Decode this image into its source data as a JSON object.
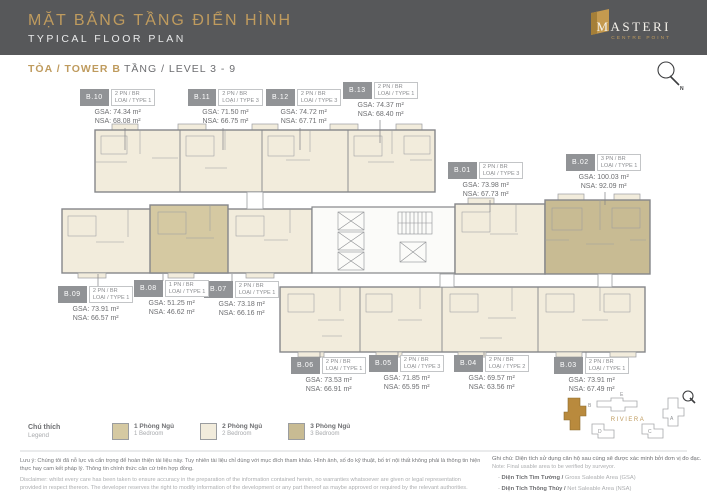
{
  "header": {
    "title_vi": "MẶT BẰNG TẦNG ĐIỂN HÌNH",
    "title_en": "TYPICAL FLOOR PLAN",
    "logo": {
      "name": "MASTERI",
      "subname": "CENTRE POINT"
    }
  },
  "subheader": {
    "tower_label": "TÒA / TOWER B",
    "level_label": "TẦNG / LEVEL 3 - 9"
  },
  "compass": {
    "label": "N"
  },
  "units": [
    {
      "id": "B.01",
      "bedrooms": "2 PN / BR",
      "type": "LOẠI / TYPE 3",
      "gsa": "GSA: 73.98 m²",
      "nsa": "NSA: 67.73 m²"
    },
    {
      "id": "B.02",
      "bedrooms": "3 PN / BR",
      "type": "LOẠI / TYPE 1",
      "gsa": "GSA: 100.03 m²",
      "nsa": "NSA: 92.09 m²"
    },
    {
      "id": "B.03",
      "bedrooms": "2 PN / BR",
      "type": "LOẠI / TYPE 1",
      "gsa": "GSA: 73.91 m²",
      "nsa": "NSA: 67.49 m²"
    },
    {
      "id": "B.04",
      "bedrooms": "2 PN / BR",
      "type": "LOẠI / TYPE 2",
      "gsa": "GSA: 69.57 m²",
      "nsa": "NSA: 63.56 m²"
    },
    {
      "id": "B.05",
      "bedrooms": "2 PN / BR",
      "type": "LOẠI / TYPE 3",
      "gsa": "GSA: 71.85 m²",
      "nsa": "NSA: 65.95 m²"
    },
    {
      "id": "B.06",
      "bedrooms": "2 PN / BR",
      "type": "LOẠI / TYPE 1",
      "gsa": "GSA: 73.53 m²",
      "nsa": "NSA: 66.91 m²"
    },
    {
      "id": "B.07",
      "bedrooms": "2 PN / BR",
      "type": "LOẠI / TYPE 1",
      "gsa": "GSA: 73.18 m²",
      "nsa": "NSA: 66.16 m²"
    },
    {
      "id": "B.08",
      "bedrooms": "1 PN / BR",
      "type": "LOẠI / TYPE 1",
      "gsa": "GSA: 51.25 m²",
      "nsa": "NSA: 46.62 m²"
    },
    {
      "id": "B.09",
      "bedrooms": "2 PN / BR",
      "type": "LOẠI / TYPE 1",
      "gsa": "GSA: 73.91 m²",
      "nsa": "NSA: 66.57 m²"
    },
    {
      "id": "B.10",
      "bedrooms": "2 PN / BR",
      "type": "LOẠI / TYPE 1",
      "gsa": "GSA: 74.34 m²",
      "nsa": "NSA: 68.08 m²"
    },
    {
      "id": "B.11",
      "bedrooms": "2 PN / BR",
      "type": "LOẠI / TYPE 3",
      "gsa": "GSA: 71.50 m²",
      "nsa": "NSA: 66.75 m²"
    },
    {
      "id": "B.12",
      "bedrooms": "2 PN / BR",
      "type": "LOẠI / TYPE 3",
      "gsa": "GSA: 74.72 m²",
      "nsa": "NSA: 67.71 m²"
    },
    {
      "id": "B.13",
      "bedrooms": "2 PN / BR",
      "type": "LOẠI / TYPE 1",
      "gsa": "GSA: 74.37 m²",
      "nsa": "NSA: 68.40 m²"
    }
  ],
  "legend": {
    "label_vi": "Chú thích",
    "label_en": "Legend",
    "items": [
      {
        "label_vi": "1 Phòng Ngủ",
        "label_en": "1 Bedroom",
        "color": "#d5c9a2"
      },
      {
        "label_vi": "2 Phòng Ngủ",
        "label_en": "2 Bedroom",
        "color": "#f2ecdc"
      },
      {
        "label_vi": "3 Phòng Ngủ",
        "label_en": "3 Bedroom",
        "color": "#c8bb93"
      }
    ]
  },
  "keyplan": {
    "district_label": "RIVIERA",
    "buildings": [
      "E",
      "B",
      "A",
      "D",
      "C"
    ],
    "highlighted": "B"
  },
  "footer": {
    "disclaimer_vi": "Lưu ý: Chúng tôi đã nỗ lực và cẩn trọng để hoàn thiện tài liệu này. Tuy nhiên tài liệu chỉ dùng với mục đích tham khảo. Hình ảnh, số đo kỹ thuật, bố trí nội thất không phải là thông tin hiện thực hay cam kết pháp lý. Thông tin chính thức căn cứ trên hợp đồng.",
    "disclaimer_en": "Disclaimer: whilst every care has been taken to ensure accuracy in the preparation of the information contained herein, no warranties whatsoever are given or legal representation provided in respect thereon. The developer reserves the right to modify information of the development or any part thereof as maybe approved or required by the relevant authorities.",
    "note_title_vi": "Ghi chú: Diện tích sử dụng căn hộ sau cùng sẽ được xác minh bởi đơn vị đo đạc.",
    "note_title_en": "Note: Final usable area to be verified by surveyor.",
    "note_items": [
      {
        "vi": "Diện Tích Tim Tường /",
        "en": "Gross Saleable Area (GSA)"
      },
      {
        "vi": "Diện Tích Thông Thủy /",
        "en": "Net Saleable Area (NSA)"
      }
    ]
  },
  "colors": {
    "header_bg": "#57585a",
    "accent_gold": "#bf9b5e",
    "keyplan_gold": "#b98a3d",
    "badge_bg": "#919396",
    "unit_1br": "#d5c9a2",
    "unit_2br": "#f2ecdc",
    "unit_3br": "#c8bb93"
  }
}
